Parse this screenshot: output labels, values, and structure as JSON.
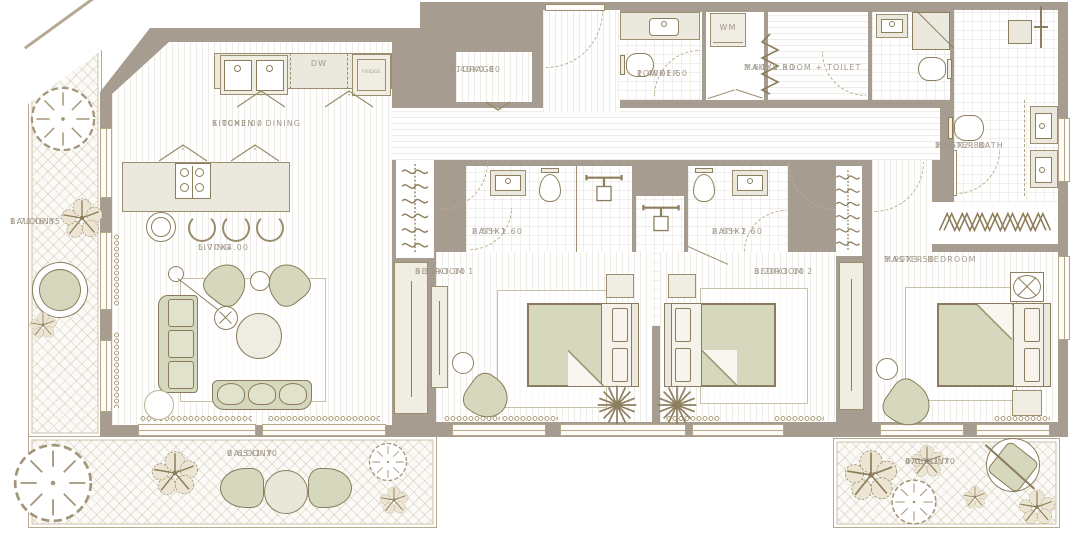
{
  "plan": {
    "title": "3-bedroom apartment floor plan",
    "rooms": {
      "kitchen_dining": {
        "name": "KITCHEN / DINING",
        "dims": "5.00x3.00"
      },
      "storage": {
        "name": "STORAGE",
        "dims": "1.40x0.80"
      },
      "powder": {
        "name": "POWDER",
        "dims": "1.40x1.50"
      },
      "maids_room": {
        "name": "MAID'S ROOM + TOILET",
        "dims": "3.60x1.50"
      },
      "master_bath": {
        "name": "MASTER BATH",
        "dims": "2.25x2.80"
      },
      "bath1": {
        "name": "BATH 1",
        "dims": "2.55x1.60"
      },
      "bath2": {
        "name": "BATH 2",
        "dims": "2.65x1.60"
      },
      "living": {
        "name": "LIVING",
        "dims": "5.70x4.00"
      },
      "bedroom1": {
        "name": "BEDROOM 1",
        "dims": "3.85x3.10"
      },
      "bedroom2": {
        "name": "BEDROOM 2",
        "dims": "3.20x3.10"
      },
      "master_bedroom": {
        "name": "MASTER BEDROOM",
        "dims": "3.90x3.50"
      },
      "balcony_left": {
        "name": "BALCONY",
        "dims": "1.70x6.85"
      },
      "balcony_bottom": {
        "name": "BALCONY",
        "dims": "7.65x1.70"
      },
      "balcony_right": {
        "name": "BALCONY",
        "dims": "4.00x1.70"
      }
    },
    "appliances": {
      "dw": "DW",
      "fridge": "FRIDGE",
      "wm": "WM"
    },
    "colors": {
      "wall": "#a69c90",
      "furniture_green": "#d5d8bd",
      "furniture_beige": "#ebe8de",
      "outline_brown": "#8d7f5e",
      "label_text": "#a2988a",
      "balcony_rail": "#b5aa8e"
    }
  }
}
